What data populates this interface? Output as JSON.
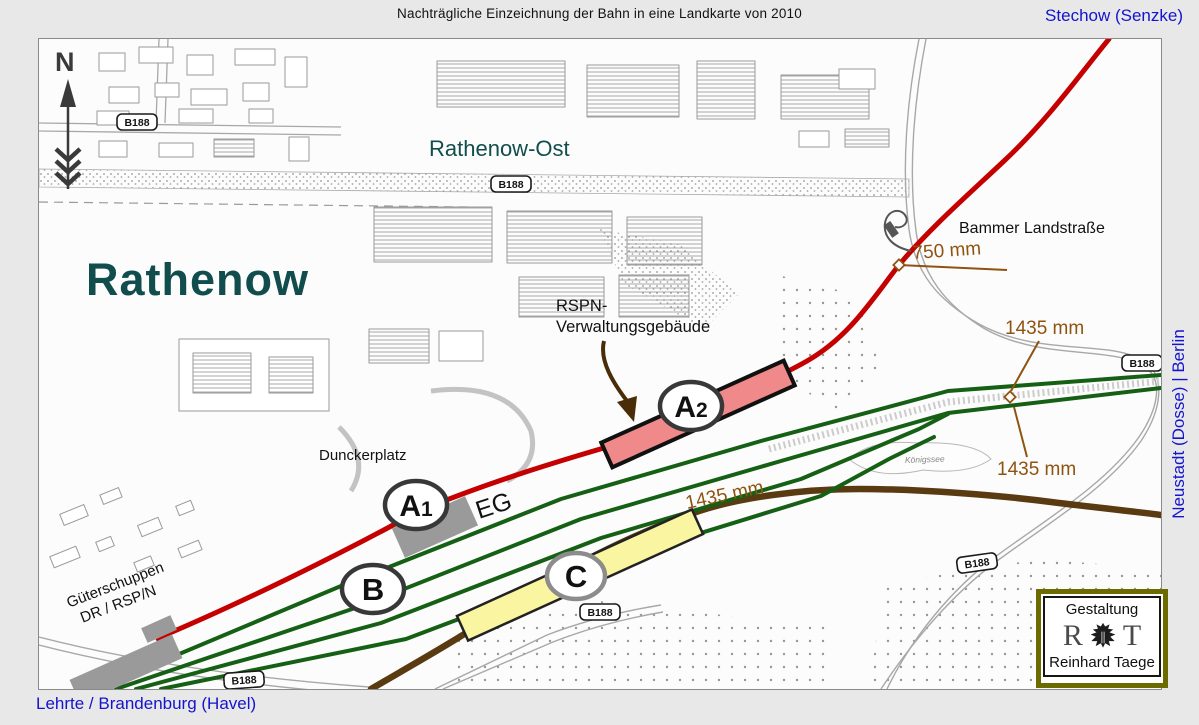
{
  "title": "Nachträgliche Einzeichnung der Bahn in eine Landkarte von 2010",
  "corridors": {
    "stechow": "Stechow (Senzke)",
    "neustadt_berlin": "Neustadt (Dosse) | Berlin",
    "lehrte_brandenburg": "Lehrte / Brandenburg (Havel)"
  },
  "map": {
    "city": "Rathenow",
    "district": "Rathenow-Ost",
    "square": "Dunckerplatz",
    "street": "Bammer Landstraße",
    "lake": "Königssee",
    "north_label": "N",
    "goods_shed": {
      "line1": "Güterschuppen",
      "line2": "DR / RSP/N"
    },
    "admin_building": {
      "line1": "RSPN-",
      "line2": "Verwaltungsgebäude"
    },
    "station_building": "EG",
    "road_badge": "B188",
    "gauge_750": "750 mm",
    "gauge_1435": "1435 mm",
    "markers": {
      "a1": {
        "label": "A",
        "sub": "1"
      },
      "a2": {
        "label": "A",
        "sub": "2"
      },
      "b": {
        "label": "B",
        "sub": ""
      },
      "c": {
        "label": "C",
        "sub": ""
      }
    }
  },
  "credit": {
    "title": "Gestaltung",
    "initial_left": "R",
    "initial_right": "T",
    "name": "Reinhard Taege"
  },
  "colors": {
    "narrow_gauge_red": "#c40000",
    "standard_gauge_green": "#156015",
    "connecting_line_brown": "#5a3a10",
    "annotation_brown": "#8f5310",
    "corridor_blue": "#1414cc",
    "city_teal": "#114d4d",
    "credit_border_olive": "#6b6b00"
  }
}
